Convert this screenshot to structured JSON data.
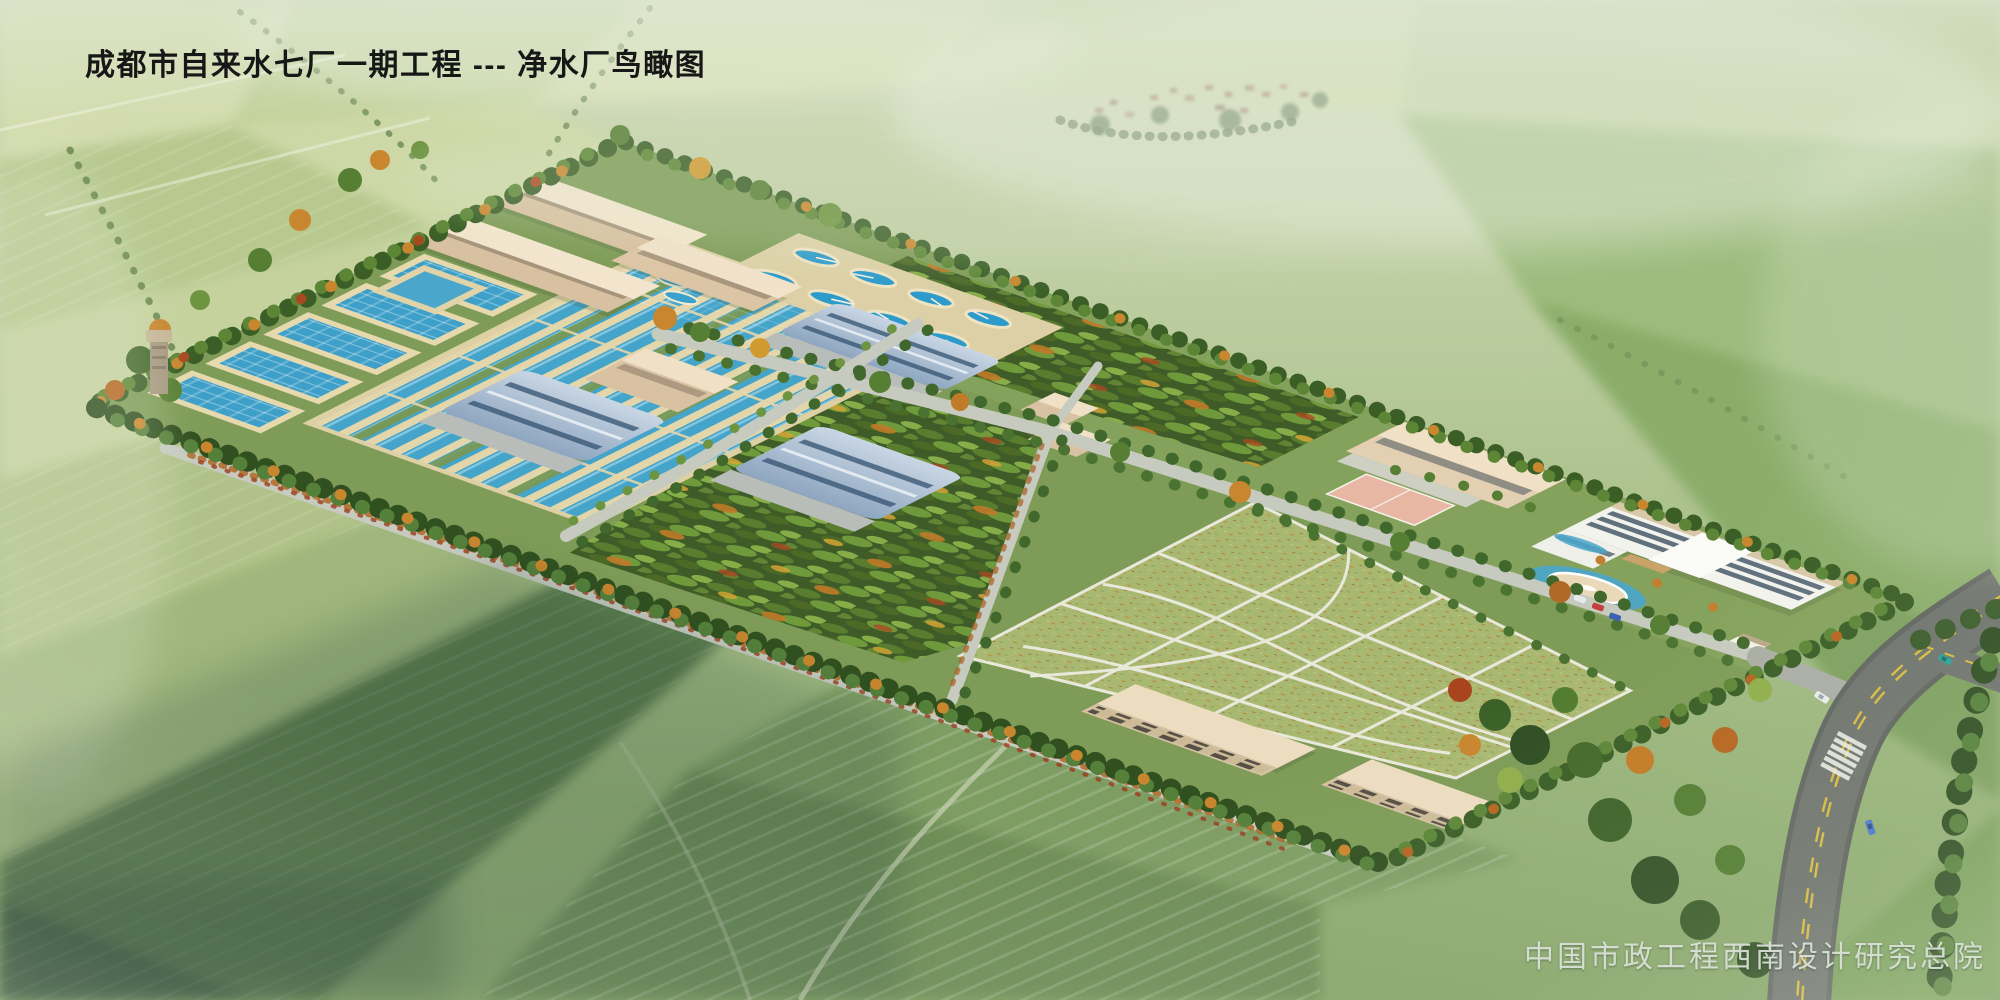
{
  "header": {
    "title": "成都市自来水七厂一期工程 --- 净水厂鸟瞰图"
  },
  "footer": {
    "credit": "中国市政工程西南设计研究总院"
  },
  "palette": {
    "field_light": "#cdd8a8",
    "field_dark": "#5c7b4e",
    "site_grass": "#7e9b57",
    "water": "#45a4c9",
    "clarifier_water": "#2d9bca",
    "basin_rim": "#e3d6ab",
    "beige_wall": "#d8c1a0",
    "beige_roof": "#f3e5cd",
    "blue_roof": "#8ea6c0",
    "lawn": "#a9b871",
    "orchard": "#3f5c28",
    "hedge_dark": "#3a5e26",
    "autumn_orange": "#c8862e",
    "road_internal": "#c6cabf",
    "road_asphalt": "#6e746d",
    "lane_yellow": "#d8bb3e"
  },
  "scene": {
    "type": "architectural-aerial-rendering",
    "features": [
      "farmland",
      "village",
      "site-boundary-trees",
      "workshop-buildings",
      "sedimentation-basins",
      "filter-channels",
      "circular-clarifiers",
      "blue-roof-filter-houses",
      "orchard",
      "lawn-garden",
      "office-building",
      "round-pavilion",
      "sports-court",
      "garage-buildings",
      "entrance-gate",
      "main-road",
      "crosswalk",
      "vehicles",
      "water-tower"
    ]
  }
}
